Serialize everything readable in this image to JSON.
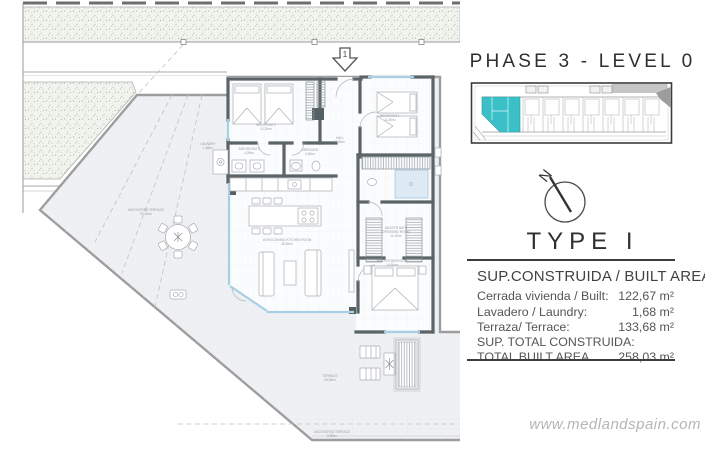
{
  "header": {
    "title": "PHASE 3 - LEVEL 0"
  },
  "compass": {
    "label": "N"
  },
  "type_block": {
    "title": "TYPE I",
    "subtitle": "SUP.CONSTRUIDA / BUILT AREA"
  },
  "area_table": {
    "rows": [
      {
        "label": "Cerrada vivienda / Built:",
        "value": "122,67 m²"
      },
      {
        "label": "Lavadero / Laundry:",
        "value": "1,68 m²"
      },
      {
        "label": "Terraza/ Terrace:",
        "value": "133,68 m²"
      }
    ],
    "total_label_line1": "SUP. TOTAL CONSTRUIDA:",
    "total_label_line2": "TOTAL BUILT AREA",
    "total_value": "258,03 m²"
  },
  "watermark": "www.medlandspain.com",
  "site_plan": {
    "highlight_color": "#3cc0c8"
  },
  "floor_plan": {
    "entrance_marker": "1",
    "labels": {
      "laundry": {
        "l1": "LAUNDRY",
        "l2": "1,68m²"
      },
      "bedroom2": {
        "l1": "BEDROOM 2",
        "l2": "12,30m²"
      },
      "bathroom2": {
        "l1": "BATHROOM 2",
        "l2": "4,25m²"
      },
      "dressing": {
        "l1": "DRESSING",
        "l2": "4,60m²"
      },
      "hall": {
        "l1": "HALL",
        "l2": "8,30m²"
      },
      "bedroom1": {
        "l1": "BEDROOM 1",
        "l2": "11,80m²"
      },
      "living": {
        "l1": "LIVING-DINING-KITCHEN ROOM",
        "l2": "45,30m²"
      },
      "master_bath": {
        "l1": "MASTER BATH",
        "l2": "DRESSING ROOM",
        "l3": "11,00m²"
      },
      "master_bedroom": {
        "l1": "MASTER BEDROOM",
        "l2": "14,50m²"
      },
      "terrace": {
        "l1": "TERRACE",
        "l2": "43,35m²"
      },
      "uncovered_left": {
        "l1": "UNCOVERED TERRACE",
        "l2": "97,00m²"
      },
      "uncovered_bottom": {
        "l1": "UNCOVERED TERRACE",
        "l2": "9,80m²"
      }
    }
  }
}
